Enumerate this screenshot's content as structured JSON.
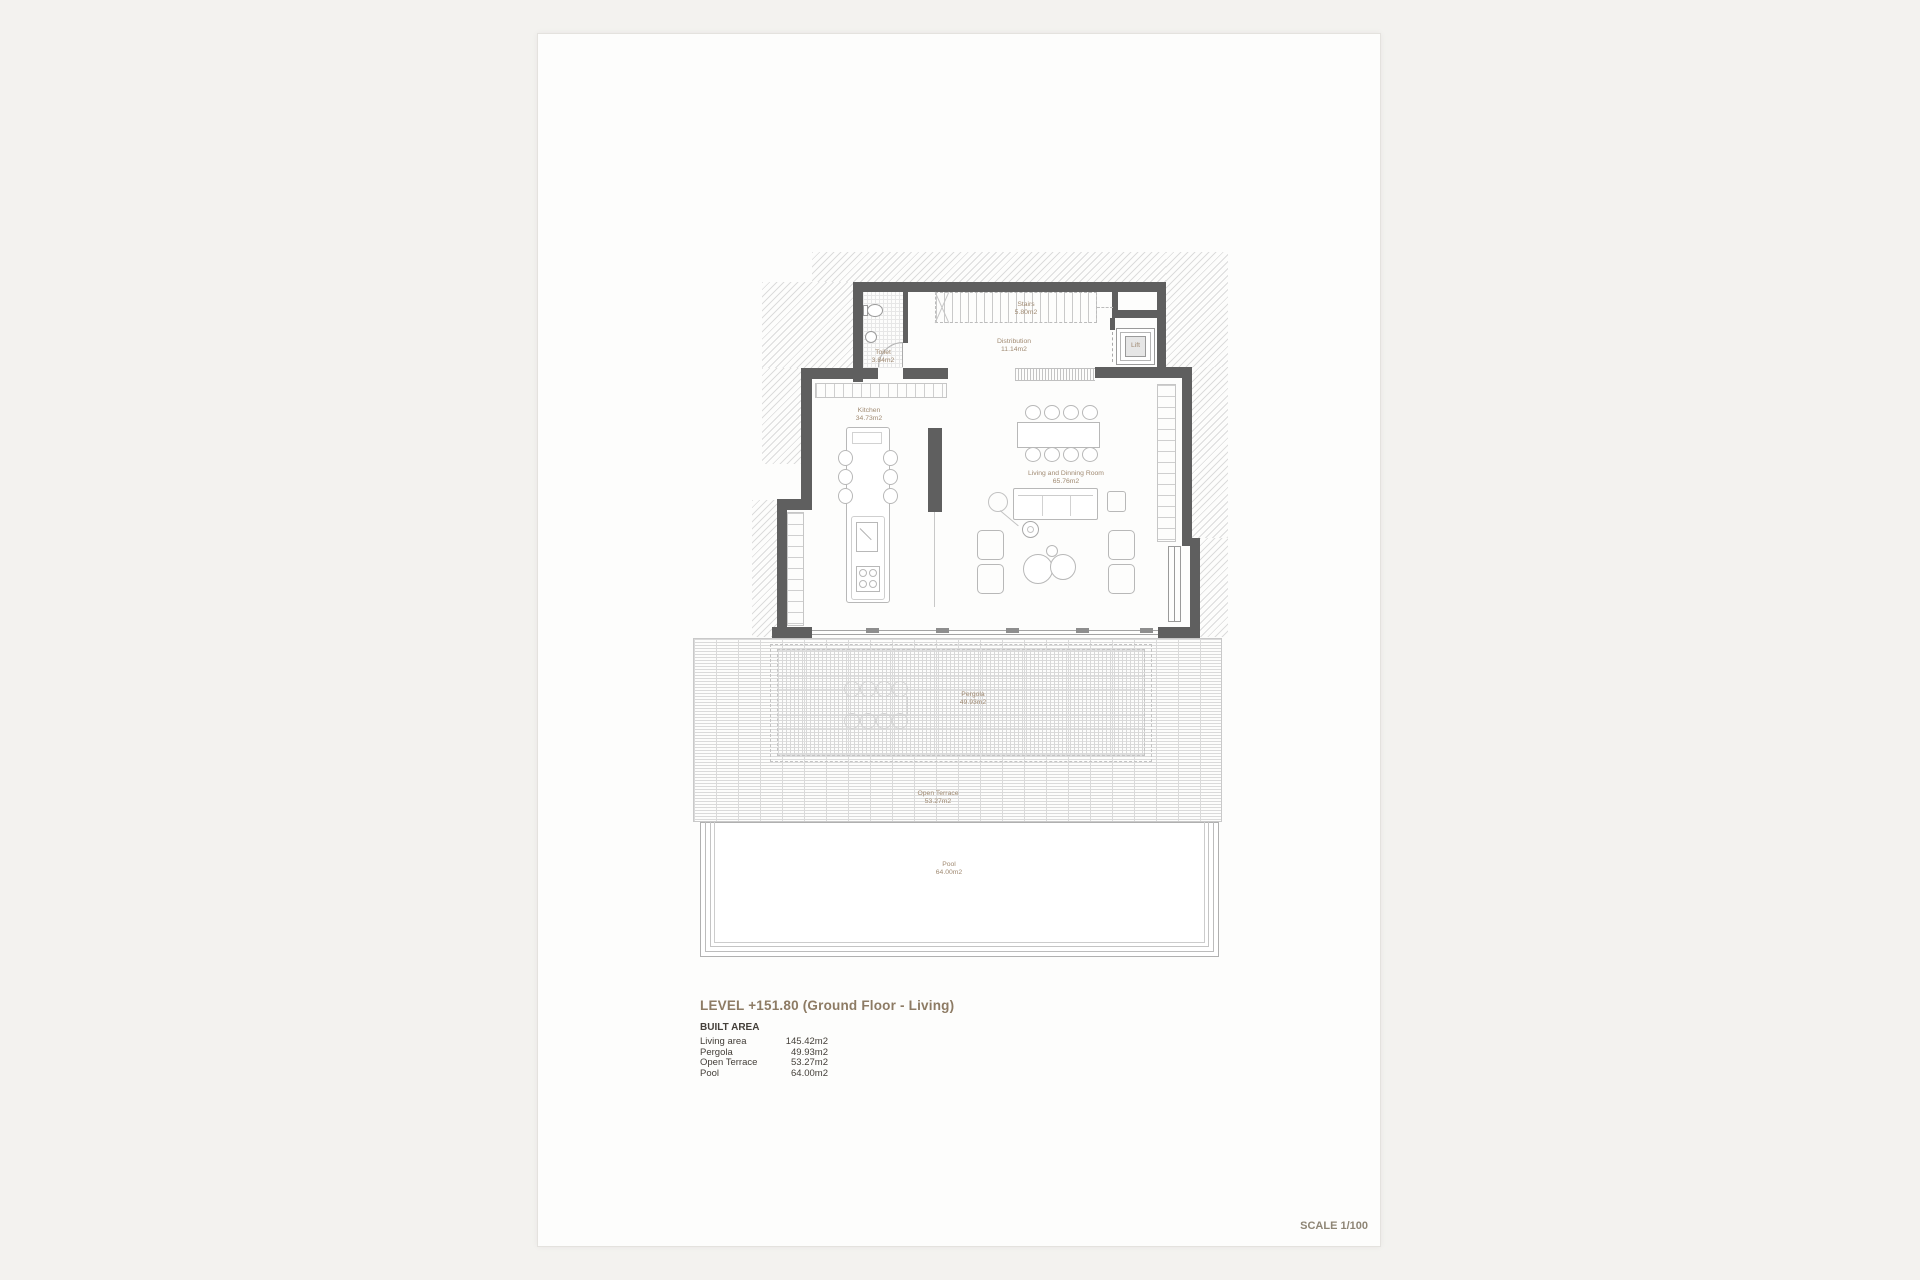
{
  "document": {
    "title": "LEVEL +151.80 (Ground Floor - Living)",
    "built_area_heading": "BUILT AREA",
    "areas": [
      {
        "label": "Living area",
        "value": "145.42m2"
      },
      {
        "label": "Pergola",
        "value": "49.93m2"
      },
      {
        "label": "Open Terrace",
        "value": "53.27m2"
      },
      {
        "label": "Pool",
        "value": "64.00m2"
      }
    ],
    "scale_label": "SCALE 1/100"
  },
  "rooms": {
    "toilet": {
      "name": "Toilet",
      "area": "3.84m2"
    },
    "stairs": {
      "name": "Stairs",
      "area": "5.80m2"
    },
    "distribution": {
      "name": "Distribution",
      "area": "11.14m2"
    },
    "lift": {
      "name": "Lift"
    },
    "kitchen": {
      "name": "Kitchen",
      "area": "34.73m2"
    },
    "living": {
      "name": "Living and Dinning Room",
      "area": "65.76m2"
    },
    "pergola": {
      "name": "Pergola",
      "area": "49.93m2"
    },
    "open_terrace": {
      "name": "Open Terrace",
      "area": "53.27m2"
    },
    "pool": {
      "name": "Pool",
      "area": "64.00m2"
    }
  },
  "colors": {
    "wall": "#5f5f5f",
    "hatch": "#dcdcdc",
    "line": "#b8b8b8",
    "ghost": "#d4d4d4",
    "grid": "#dadada",
    "label": "#a08a72",
    "title": "#8d7b64",
    "text": "#45403a",
    "scale": "#8e8575",
    "page-bg": "#fdfdfc",
    "canvas-bg": "#f3f2ef"
  }
}
